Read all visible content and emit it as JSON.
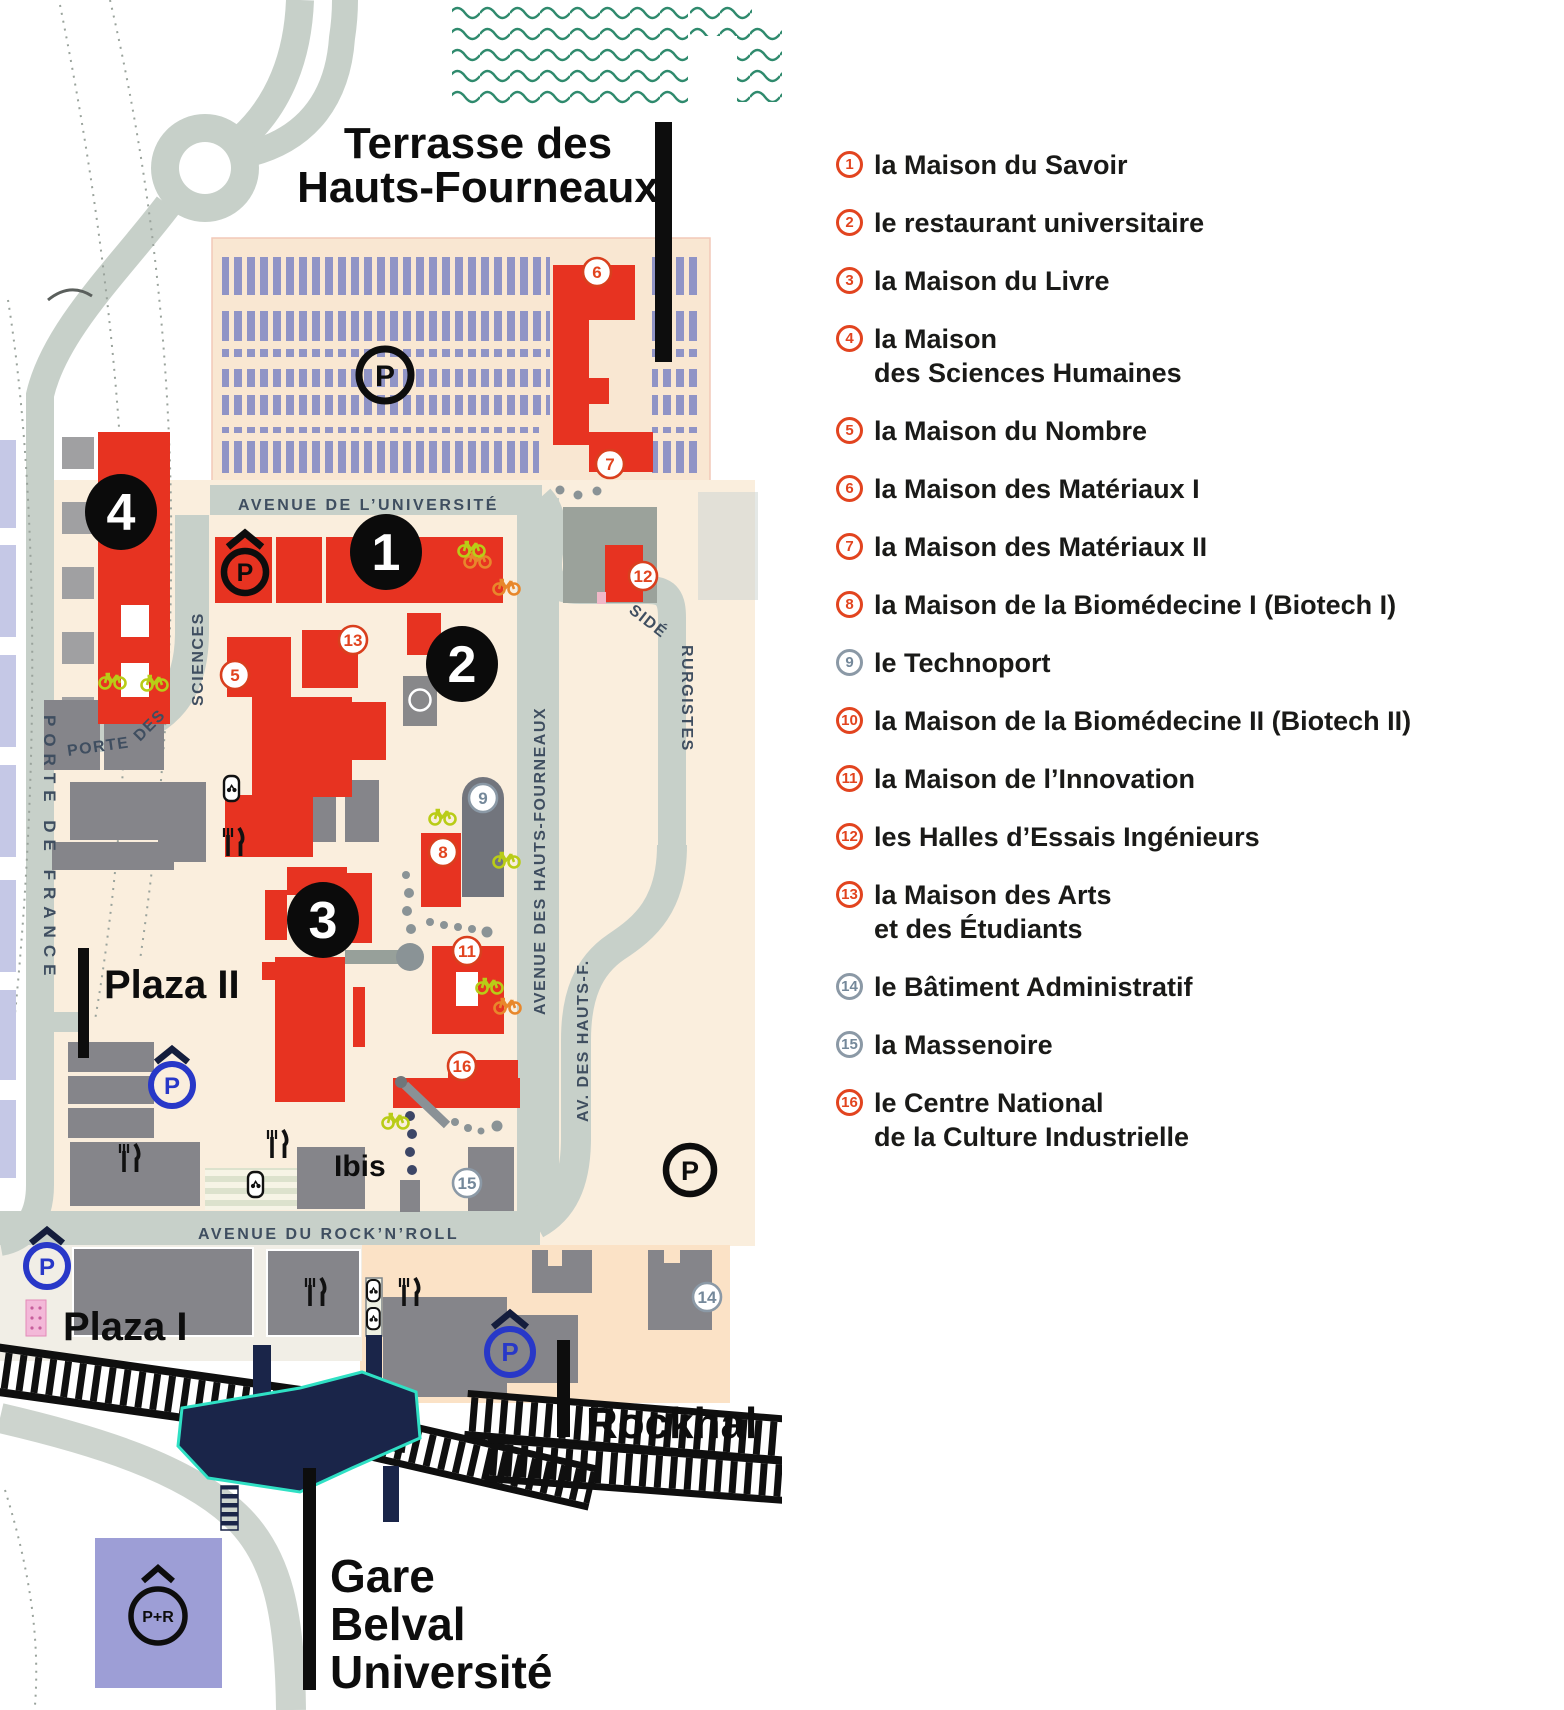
{
  "legend": {
    "items": [
      {
        "num": "1",
        "variant": "red",
        "line1": "la Maison du Savoir",
        "line2": ""
      },
      {
        "num": "2",
        "variant": "red",
        "line1": "le restaurant universitaire",
        "line2": ""
      },
      {
        "num": "3",
        "variant": "red",
        "line1": "la Maison du Livre",
        "line2": ""
      },
      {
        "num": "4",
        "variant": "red",
        "line1": "la Maison",
        "line2": "des Sciences Humaines"
      },
      {
        "num": "5",
        "variant": "red",
        "line1": "la Maison du Nombre",
        "line2": ""
      },
      {
        "num": "6",
        "variant": "red",
        "line1": "la Maison des Matériaux I",
        "line2": ""
      },
      {
        "num": "7",
        "variant": "red",
        "line1": "la Maison des Matériaux II",
        "line2": ""
      },
      {
        "num": "8",
        "variant": "red",
        "line1": "la Maison de la Biomédecine I (Biotech I)",
        "line2": ""
      },
      {
        "num": "9",
        "variant": "gray",
        "line1": "le Technoport",
        "line2": ""
      },
      {
        "num": "10",
        "variant": "red",
        "line1": "la Maison de la Biomédecine II (Biotech II)",
        "line2": ""
      },
      {
        "num": "11",
        "variant": "red",
        "line1": "la Maison de l’Innovation",
        "line2": ""
      },
      {
        "num": "12",
        "variant": "red",
        "line1": "les Halles d’Essais Ingénieurs",
        "line2": ""
      },
      {
        "num": "13",
        "variant": "red",
        "line1": "la Maison des Arts",
        "line2": "et des Étudiants"
      },
      {
        "num": "14",
        "variant": "gray",
        "line1": "le Bâtiment Administratif",
        "line2": ""
      },
      {
        "num": "15",
        "variant": "gray",
        "line1": "la Massenoire",
        "line2": ""
      },
      {
        "num": "16",
        "variant": "red",
        "line1": "le Centre National",
        "line2": "de la Culture Industrielle"
      }
    ]
  },
  "map": {
    "title": {
      "line1": "Terrasse des",
      "line2": "Hauts-Fourneaux"
    },
    "areas": {
      "plaza2": "Plaza II",
      "plaza1": "Plaza I",
      "rockhal": "Rockhal",
      "ibis": "Ibis",
      "gare_l1": "Gare",
      "gare_l2": "Belval",
      "gare_l3": "Université"
    },
    "streets": {
      "universite": "AVENUE DE L’UNIVERSITÉ",
      "rocknroll": "AVENUE DU ROCK’N’ROLL",
      "porte_france": "PORTE DE FRANCE",
      "porte_sciences_p1": "PORTE",
      "porte_sciences_p2": "DES",
      "porte_sciences_p3": "SCIENCES",
      "hauts_fourneaux": "AVENUE DES HAUTS-FOURNEAUX",
      "hauts_f": "AV. DES HAUTS-F.",
      "siderurgistes_p1": "SIDÉ",
      "siderurgistes_p2": "RURGISTES"
    },
    "markers": {
      "m1": "1",
      "m2": "2",
      "m3": "3",
      "m4": "4",
      "m5": "5",
      "m6": "6",
      "m7": "7",
      "m8": "8",
      "m9": "9",
      "m11": "11",
      "m12": "12",
      "m13": "13",
      "m14": "14",
      "m15": "15",
      "m16": "16"
    },
    "icons": {
      "parking": "P",
      "park_ride": "P+R"
    }
  },
  "colors": {
    "cream": "#faeedd",
    "parking_bg": "#f9e7d2",
    "peach": "#fbe2c6",
    "road": "#c7d0c9",
    "red_building": "#e73321",
    "gray_building": "#85858a",
    "navy": "#1a2549",
    "teal_glow": "#2fe0c4",
    "stripe_purple": "#9094c6",
    "park_ride_square": "#9d9ed6",
    "wave": "#2f8a6d",
    "marker_red": "#e2441f",
    "marker_gray": "#8b99a6",
    "blue_parking": "#2838c8",
    "street_label": "#3f4e60"
  }
}
